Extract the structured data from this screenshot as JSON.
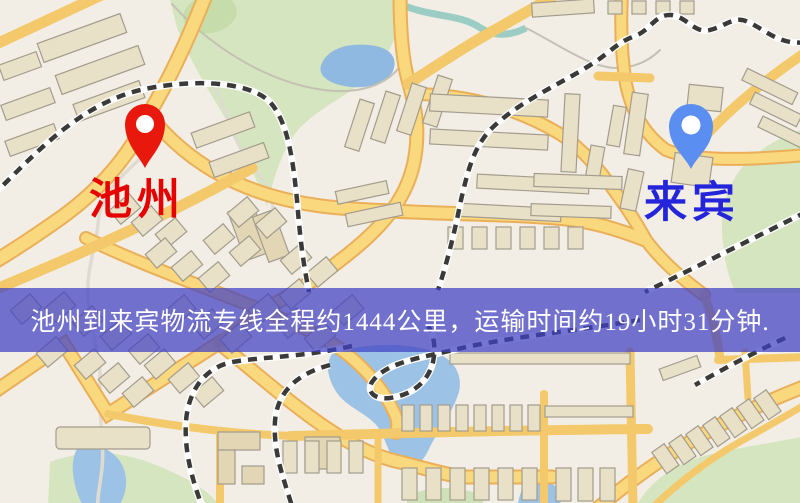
{
  "origin": {
    "name": "池州",
    "pin_color": "#e8190c",
    "label_color": "#e60000"
  },
  "destination": {
    "name": "来宾",
    "pin_color": "#5a8ef0",
    "label_color": "#2424da"
  },
  "banner": {
    "text": "池州到来宾物流专线全程约1444公里，运输时间约19小时31分钟.",
    "distance_km": "1444",
    "duration_hours": "19",
    "duration_minutes": "31",
    "background_color": "#4040c4",
    "text_color": "#ffffff"
  },
  "map_palette": {
    "land": "#f2eee6",
    "road_fill": "#f9d87e",
    "road_edge": "#eaaf58",
    "minor_road": "#f3c96b",
    "water": "#9cc2e6",
    "park": "#d5e5bf",
    "building": "#e9e1c7",
    "railway": "#3a3a38"
  }
}
